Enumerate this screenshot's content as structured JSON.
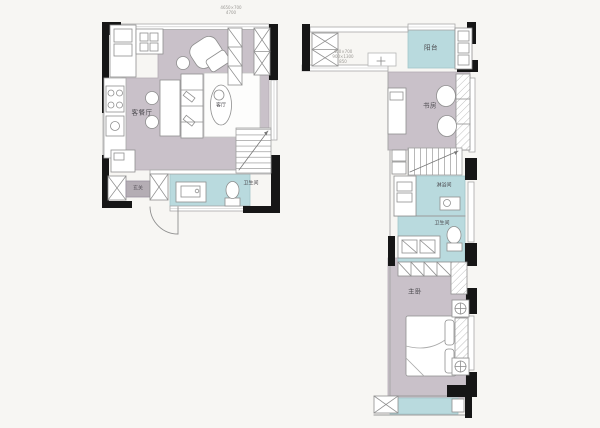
{
  "page": {
    "title": "loft-floor-plan",
    "background": "#f7f6f3"
  },
  "palette": {
    "wall": "#161616",
    "floor_main": "#c9c1c9",
    "floor_wet": "#b9dade",
    "furniture_line": "#8f8f8f",
    "annotation_text": "#9b9995"
  },
  "left_plan": {
    "name": "first-floor-plan",
    "labels": {
      "living_dining": "客餐厅",
      "living": "客厅",
      "bathroom": "卫生间",
      "entry": "玄关"
    },
    "annotation": [
      "4650×700",
      "4700"
    ]
  },
  "right_plan": {
    "name": "second-floor-plan",
    "labels": {
      "balcony": "阳台",
      "study": "书房",
      "shower": "淋浴间",
      "bathroom": "卫生间",
      "master_bedroom": "主卧"
    },
    "annotation": [
      "400×700",
      "900×1300",
      "850"
    ]
  }
}
